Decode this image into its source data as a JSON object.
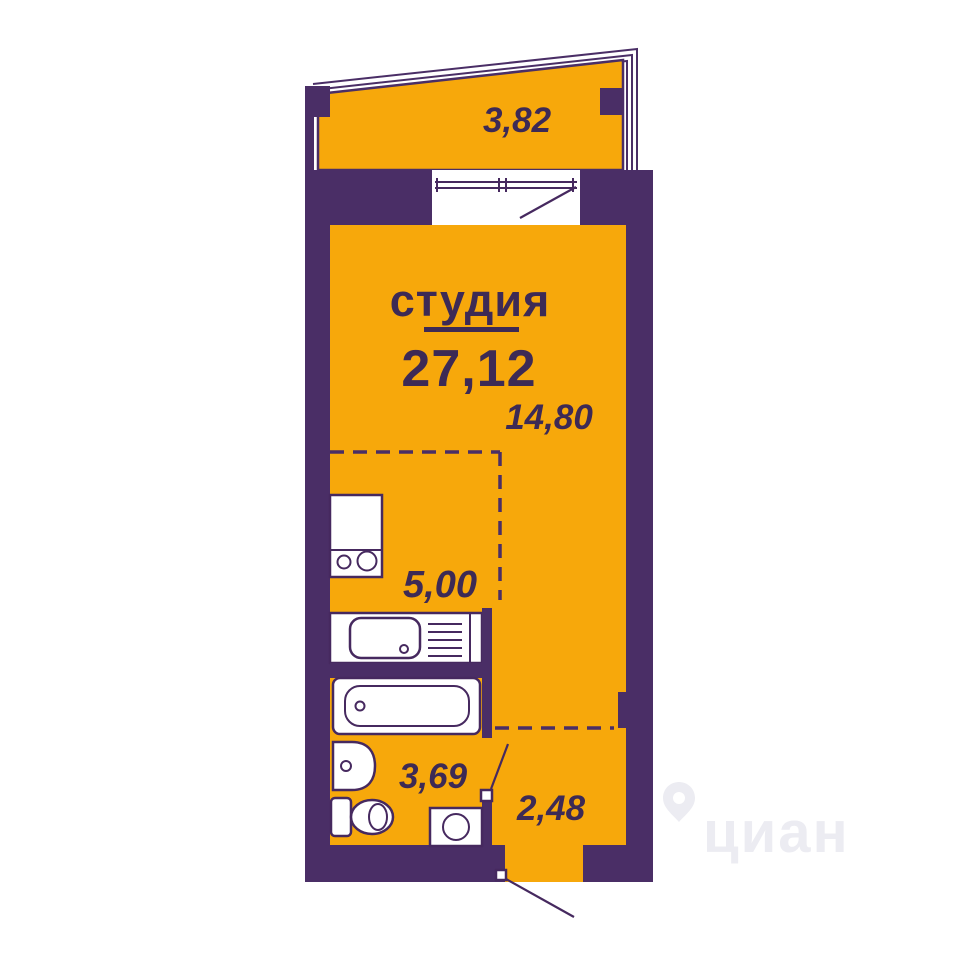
{
  "plan": {
    "type_label": "студия",
    "total_area": "27,12",
    "areas": {
      "studio": "14,80",
      "kitchen": "5,00",
      "bathroom": "3,69",
      "hallway": "2,48",
      "balcony": "3,82"
    },
    "watermark": "циан",
    "colors": {
      "wall": "#4a2e66",
      "floor": "#f7a80b",
      "fixture": "#ffffff",
      "line": "#46295f",
      "text": "#3d2a55",
      "watermark": "#ececf2"
    }
  }
}
